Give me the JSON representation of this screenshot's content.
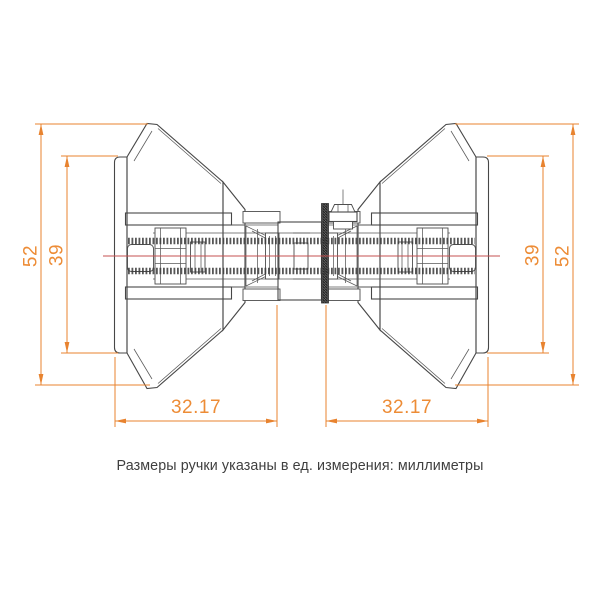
{
  "caption": "Размеры ручки указаны в ед. измерения: миллиметры",
  "dimensions": {
    "left_outer": "52",
    "left_inner": "39",
    "right_inner": "39",
    "right_outer": "52",
    "bottom_left": "32.17",
    "bottom_right": "32.17"
  },
  "colors": {
    "dimension_accent": "#E8832F",
    "dimension_text": "#ED8C36",
    "centerline_red": "#C65050",
    "drawing_outline": "#474747",
    "background": "#ffffff"
  },
  "drawing": {
    "subject": "door-knob-cross-section",
    "views": [
      "left-knob-section",
      "right-knob-section",
      "central-spindle"
    ]
  }
}
